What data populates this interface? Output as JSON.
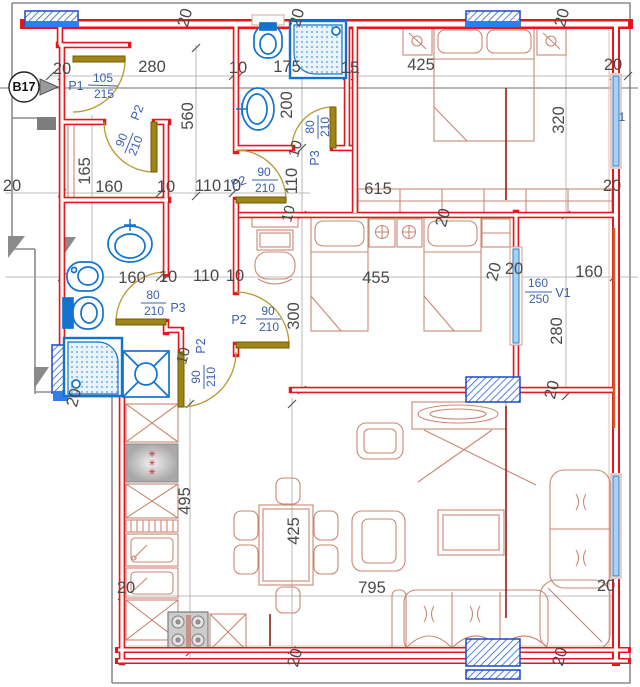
{
  "drawing": {
    "unit_label": "B17",
    "edge_mark": "1",
    "stove_mark": "✳",
    "colors": {
      "wall": "#e8151c",
      "fixture": "#1273cf",
      "furniture": "#c98874",
      "door_leaf": "#a08416",
      "door_arc": "#b79a33",
      "dim_text": "#4a4a4a",
      "label_text": "#3a5fae",
      "window_glass": "#a9d2f2",
      "pillar_hatch": "#2b5fd6",
      "section_line": "#8e2012"
    },
    "doors": [
      {
        "id": "P1",
        "width": "105",
        "height": "215"
      },
      {
        "id": "P2",
        "width": "90",
        "height": "210"
      },
      {
        "id": "P3",
        "width": "80",
        "height": "210"
      },
      {
        "id": "P2",
        "width": "90",
        "height": "210"
      },
      {
        "id": "P3",
        "width": "80",
        "height": "210"
      },
      {
        "id": "P2",
        "width": "90",
        "height": "210"
      },
      {
        "id": "P2",
        "width": "90",
        "height": "210"
      }
    ],
    "windows": [
      {
        "id": "V1",
        "width": "160",
        "height": "250"
      }
    ],
    "dims": [
      "20",
      "280",
      "10",
      "175",
      "15",
      "425",
      "20",
      "20",
      "20",
      "20",
      "320",
      "560",
      "165",
      "160",
      "10",
      "110",
      "10",
      "20",
      "200",
      "110",
      "10",
      "615",
      "20",
      "160",
      "10",
      "110",
      "10",
      "455",
      "300",
      "160",
      "20",
      "20",
      "280",
      "10",
      "20",
      "20",
      "10",
      "20",
      "495",
      "425",
      "20",
      "795",
      "20",
      "20",
      "20"
    ]
  }
}
